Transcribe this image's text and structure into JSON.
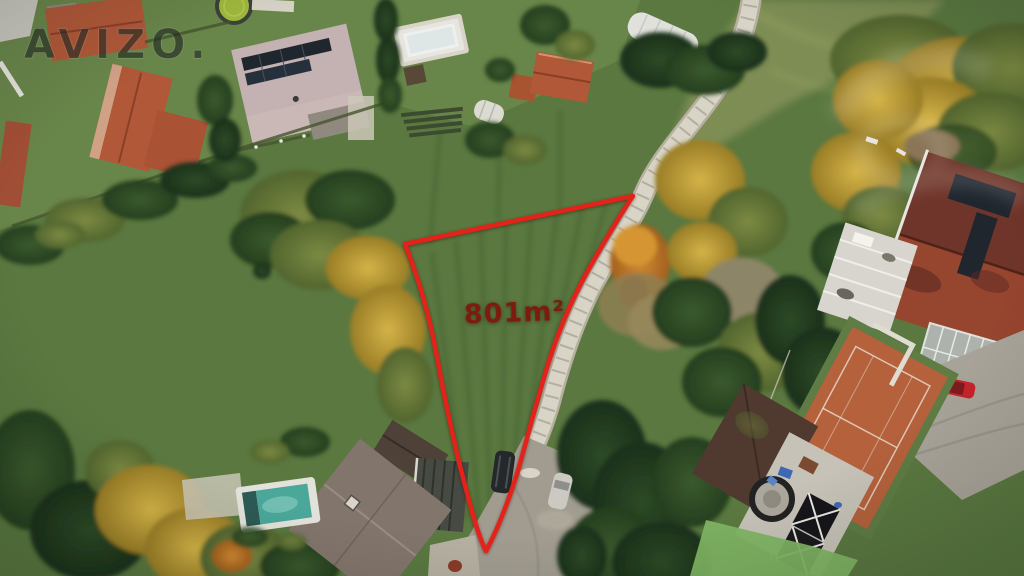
{
  "watermark": {
    "text": "AVIZO.",
    "color": "rgba(30,39,33,0.62)"
  },
  "plot": {
    "area_label": "801m²",
    "outline_color": "#e3231a",
    "label_color": "#7d1c0e"
  },
  "palette": {
    "meadow": "#5a7840",
    "garden_lawn": "#6d8a4c",
    "pale_meadow": "#87935a",
    "stone_path": "#d8d4c6",
    "path_casing": "#b5b09f",
    "gravel": "#a19c8f",
    "tennis_clay": "#b4613c",
    "pool_water": "#4aa79a",
    "empty_pool": "#eef0ee",
    "roof_terracotta": "#b05838",
    "roof_pink_gray": "#c4b1b1",
    "roof_maroon": "#6f352a",
    "roof_brown_gray": "#82756c",
    "solar_panel": "#1f262e",
    "conifer_green": "#2e4a27",
    "autumn_yellow": "#c8a83e",
    "autumn_orange": "#c8862e"
  }
}
